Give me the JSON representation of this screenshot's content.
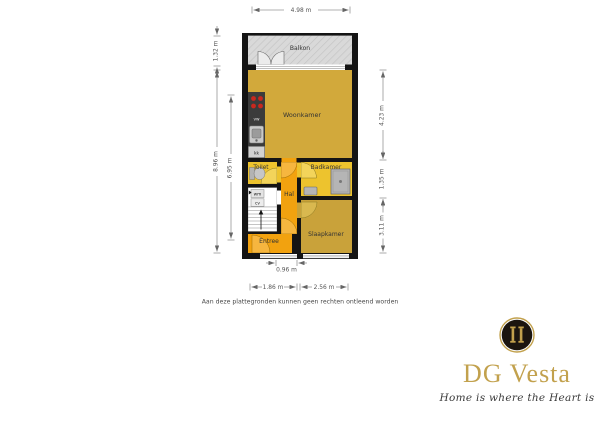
{
  "floorplan": {
    "rooms": {
      "balkon": "Balkon",
      "woonkamer": "Woonkamer",
      "toilet": "Toilet",
      "badkamer": "Badkamer",
      "hal": "Hal",
      "entree": "Entree",
      "slaapkamer": "Slaapkamer"
    },
    "appliances": {
      "vw": "vw",
      "kk": "kk",
      "wm": "wm",
      "cv": "cv"
    },
    "dimensions": {
      "top_width": "4.98 m",
      "balkon_height": "1.32 m",
      "left_total": "8.96 m",
      "left_inner": "6.95 m",
      "right_woonkamer": "4.23 m",
      "right_badkamer": "1.35 m",
      "right_slaapkamer": "3.11 m",
      "bottom_door": "0.96 m",
      "bottom_left": "1.86 m",
      "bottom_right": "2.56 m"
    },
    "disclaimer": "Aan deze plattegronden kunnen geen rechten ontleend worden",
    "colors": {
      "wall": "#141414",
      "balkon": "#d9d9d9",
      "woonkamer": "#D2A93B",
      "slaapkamer": "#C9A23A",
      "wetroom_yellow": "#EDC32E",
      "hal_orange": "#F2A20F",
      "kitchen_dark": "#3b3b3b",
      "burner_red": "#C8281E"
    }
  },
  "logo": {
    "name": "DG Vesta",
    "tagline": "Home is where the Heart is",
    "gold": "#C2A14D"
  }
}
